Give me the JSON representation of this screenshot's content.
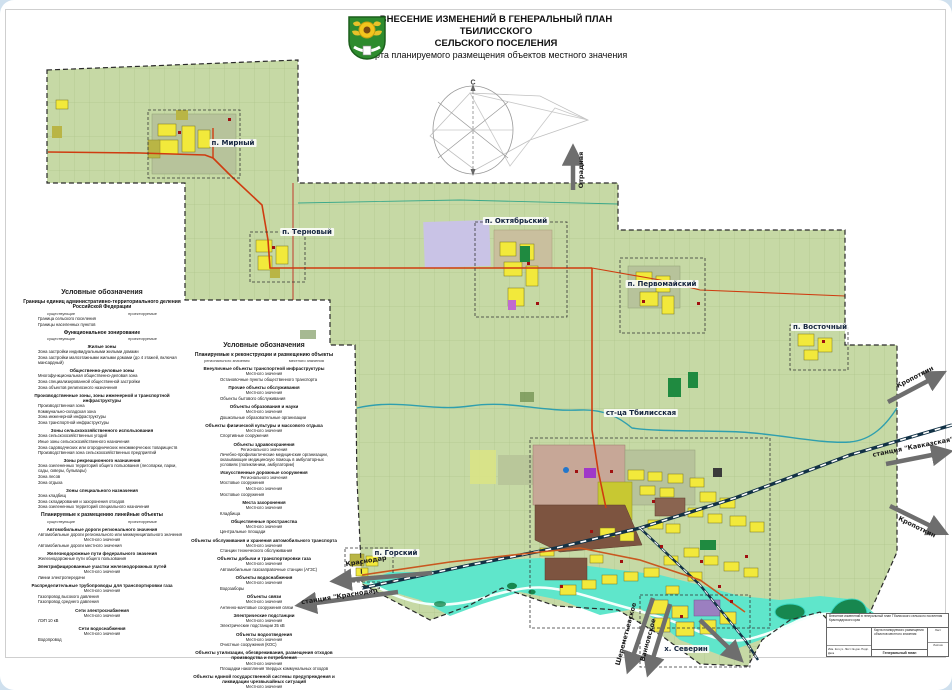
{
  "header": {
    "title_line1": "ВНЕСЕНИЕ ИЗМЕНЕНИЙ В ГЕНЕРАЛЬНЫЙ ПЛАН ТБИЛИССКОГО",
    "title_line2": "СЕЛЬСКОГО ПОСЕЛЕНИЯ",
    "subtitle": "Карта планируемого размещения объектов местного значения"
  },
  "compass": {
    "north": "С",
    "south": "Ю"
  },
  "map": {
    "labels": [
      {
        "text": "п. Мирный",
        "x": 233,
        "y": 143
      },
      {
        "text": "п. Терновый",
        "x": 307,
        "y": 232
      },
      {
        "text": "п. Октябрьский",
        "x": 516,
        "y": 221
      },
      {
        "text": "п. Первомайский",
        "x": 662,
        "y": 284
      },
      {
        "text": "п. Восточный",
        "x": 820,
        "y": 327
      },
      {
        "text": "ст-ца Тбилисская",
        "x": 641,
        "y": 413
      },
      {
        "text": "п. Горский",
        "x": 396,
        "y": 553
      },
      {
        "text": "х. Северин",
        "x": 686,
        "y": 649
      }
    ],
    "arrows": [
      {
        "x1": 573,
        "y1": 190,
        "x2": 573,
        "y2": 150,
        "label": "Отрадная",
        "lx": 581,
        "ly": 170,
        "rot": -90
      },
      {
        "x1": 888,
        "y1": 402,
        "x2": 941,
        "y2": 374,
        "label": "Кропоткин",
        "lx": 915,
        "ly": 377,
        "rot": -27
      },
      {
        "x1": 886,
        "y1": 464,
        "x2": 947,
        "y2": 452,
        "label": "станция \"Кавказская\"",
        "lx": 913,
        "ly": 447,
        "rot": -11
      },
      {
        "x1": 890,
        "y1": 506,
        "x2": 943,
        "y2": 532,
        "label": "Кропоткин",
        "lx": 917,
        "ly": 527,
        "rot": 26
      },
      {
        "x1": 432,
        "y1": 573,
        "x2": 336,
        "y2": 581,
        "label": "Краснодар",
        "lx": 366,
        "ly": 561,
        "rot": -9
      },
      {
        "x1": 398,
        "y1": 592,
        "x2": 301,
        "y2": 605,
        "label": "станция \"Краснодар\"",
        "lx": 341,
        "ly": 596,
        "rot": -9
      },
      {
        "x1": 653,
        "y1": 598,
        "x2": 629,
        "y2": 668,
        "label": "Шереметьевское",
        "lx": 626,
        "ly": 634,
        "rot": -75
      },
      {
        "x1": 670,
        "y1": 604,
        "x2": 649,
        "y2": 671,
        "label": "Ванновское",
        "lx": 648,
        "ly": 640,
        "rot": -75
      },
      {
        "x1": 700,
        "y1": 620,
        "x2": 739,
        "y2": 658,
        "label": "",
        "lx": 0,
        "ly": 0,
        "rot": 0
      }
    ]
  },
  "legend_left": {
    "rows": [
      {
        "t": "h1",
        "label": "Условные обозначения"
      },
      {
        "t": "h2",
        "label": "Границы единиц административно-территориального деления Российской Федерации"
      },
      {
        "t": "cols",
        "a": "существующие",
        "b": "проектируемые"
      },
      {
        "t": "item",
        "sw": "#1c1c1c",
        "swk": "line",
        "label": "Граница сельского поселения"
      },
      {
        "t": "item",
        "sw": "#d43fc0",
        "swk": "dash",
        "label": "Границы населенных пунктов"
      },
      {
        "t": "h2",
        "label": "Функциональное зонирование"
      },
      {
        "t": "cols",
        "a": "существующие",
        "b": "проектируемые"
      },
      {
        "t": "h3",
        "label": "Жилые зоны"
      },
      {
        "t": "item",
        "sw": "#f8ef4a",
        "swk": "rect",
        "label": "Зона застройки индивидуальными жилыми домами"
      },
      {
        "t": "item",
        "sw": "#dfa23b",
        "swk": "rect",
        "label": "Зона застройки малоэтажными жилыми домами (до 4 этажей, включая мансардный)"
      },
      {
        "t": "h3",
        "label": "Общественно-деловые зоны"
      },
      {
        "t": "item",
        "sw": "#d43fc0",
        "swk": "rect",
        "label": "Многофункциональная общественно-деловая зона"
      },
      {
        "t": "item",
        "sw": "#9a63b8",
        "swk": "rect",
        "label": "Зона специализированной общественной застройки"
      },
      {
        "t": "item",
        "sw": "#6f4d9b",
        "swk": "rect",
        "label": "Зона объектов религиозного назначения"
      },
      {
        "t": "h3",
        "label": "Производственные зоны, зоны инженерной и транспортной инфраструктуры"
      },
      {
        "t": "item",
        "sw": "#7c4a38",
        "swk": "rect",
        "label": "Производственная зона"
      },
      {
        "t": "item",
        "sw": "#8f7a66",
        "swk": "rect",
        "label": "Коммунально-складская зона"
      },
      {
        "t": "item",
        "sw": "#33525f",
        "swk": "rect",
        "label": "Зона инженерной инфраструктуры"
      },
      {
        "t": "item",
        "sw": "#24405a",
        "swk": "rect",
        "label": "Зона транспортной инфраструктуры"
      },
      {
        "t": "h3",
        "label": "Зоны сельскохозяйственного использования"
      },
      {
        "t": "item",
        "sw": "#cfc99c",
        "swk": "rect",
        "label": "Зона сельскохозяйственных угодий"
      },
      {
        "t": "item",
        "sw": "#f0eec0",
        "swk": "rect",
        "label": "Иные зоны сельскохозяйственного назначения"
      },
      {
        "t": "item",
        "sw": "#d9e386",
        "swk": "rect",
        "label": "Зона садоводческих или огороднических некоммерческих товариществ"
      },
      {
        "t": "item",
        "sw": "#b5ba3f",
        "swk": "rect",
        "label": "Производственная зона сельскохозяйственных предприятий"
      },
      {
        "t": "h3",
        "label": "Зоны рекреационного назначения"
      },
      {
        "t": "item",
        "sw": "#4fd8a9",
        "swk": "rect",
        "label": "Зона озелененных территорий общего пользования (лесопарки, парки, сады, скверы, бульвары)"
      },
      {
        "t": "item",
        "sw": "#42bd72",
        "swk": "rect",
        "label": "Зона лесов"
      },
      {
        "t": "item",
        "sw": "#e4705e",
        "swk": "rect",
        "label": "Зона отдыха"
      },
      {
        "t": "h3",
        "label": "Зоны специального назначения"
      },
      {
        "t": "item",
        "sw": "#3c3c3c",
        "swk": "rect",
        "label": "Зона кладбищ"
      },
      {
        "t": "item",
        "sw": "#cdbfeb",
        "swk": "rect",
        "label": "Зона складирования и захоронения отходов"
      },
      {
        "t": "item",
        "sw": "#dcd6f2",
        "swk": "rect",
        "label": "Зона озелененных территорий специального назначения"
      },
      {
        "t": "h2",
        "label": "Планируемые к размещению линейные объекты"
      },
      {
        "t": "cols",
        "a": "существующие",
        "b": "проектируемые"
      },
      {
        "t": "h3",
        "label": "Автомобильные дороги регионального значения"
      },
      {
        "t": "item",
        "sw": "#c9571f",
        "swk": "line",
        "label": "Автомобильные дороги регионального или межмуниципального значения"
      },
      {
        "t": "tier",
        "label": "Местного значения"
      },
      {
        "t": "item",
        "sw": "#d98a4a",
        "swk": "line",
        "label": "Автомобильные дороги местного значения"
      },
      {
        "t": "h3",
        "label": "Железнодорожные пути федерального значения"
      },
      {
        "t": "item",
        "sw": "#1c1c1c",
        "swk": "line",
        "label": "Железнодорожные пути общего пользования"
      },
      {
        "t": "h3",
        "label": "Электрифицированные участки железнодорожных путей"
      },
      {
        "t": "tier",
        "label": "Местного значения"
      },
      {
        "t": "item",
        "sw": "#777777",
        "swk": "dash",
        "label": "Линии электропередачи"
      },
      {
        "t": "h3",
        "label": "Распределительные трубопроводы для транспортировки газа"
      },
      {
        "t": "tier",
        "label": "Местного значения"
      },
      {
        "t": "item",
        "sw": "#b8743c",
        "swk": "dash",
        "label": "Газопровод высокого давления"
      },
      {
        "t": "item",
        "sw": "#4a79b0",
        "swk": "dash",
        "label": "Газопровод среднего давления"
      },
      {
        "t": "h3",
        "label": "Сети электроснабжения"
      },
      {
        "t": "tier",
        "label": "Местного значения"
      },
      {
        "t": "item",
        "sw": "#8a5fa0",
        "swk": "dash",
        "label": "ЛЭП 10 кВ"
      },
      {
        "t": "h3",
        "label": "Сети водоснабжения"
      },
      {
        "t": "tier",
        "label": "Местного значения"
      },
      {
        "t": "item",
        "sw": "#3d86c6",
        "swk": "line",
        "label": "Водопровод"
      }
    ]
  },
  "legend_center": {
    "rows": [
      {
        "t": "h1",
        "label": "Условные обозначения"
      },
      {
        "t": "h2",
        "label": "Планируемые к реконструкции и размещению объекты"
      },
      {
        "t": "cols",
        "a": "регионального значения",
        "b": "местного значения"
      },
      {
        "t": "h3",
        "label": "Внеуличные объекты транспортной инфраструктуры"
      },
      {
        "t": "tier",
        "label": "Местного значения"
      },
      {
        "t": "item",
        "sw": "#b01010",
        "swk": "sq",
        "label": "Остановочные пункты общественного транспорта"
      },
      {
        "t": "h3",
        "label": "Прочие объекты обслуживания"
      },
      {
        "t": "tier",
        "label": "Местного значения"
      },
      {
        "t": "item",
        "sw": "#b01010",
        "swk": "sq",
        "label": "Объекты бытового обслуживания"
      },
      {
        "t": "h3",
        "label": "Объекты образования и науки"
      },
      {
        "t": "tier",
        "label": "Местного значения"
      },
      {
        "t": "item",
        "sw": "#b01010",
        "swk": "sq",
        "label": "Дошкольные образовательные организации"
      },
      {
        "t": "h3",
        "label": "Объекты физической культуры и массового отдыха"
      },
      {
        "t": "tier",
        "label": "Местного значения"
      },
      {
        "t": "item",
        "sw": "#b01010",
        "swk": "sq",
        "label": "Спортивные сооружения"
      },
      {
        "t": "h3",
        "label": "Объекты здравоохранения"
      },
      {
        "t": "tier",
        "label": "Регионального значения"
      },
      {
        "t": "item",
        "sw": "#6aa83c",
        "swk": "sq",
        "label": "Лечебно-профилактические медицинские организации, оказывающие медицинскую помощь в амбулаторных условиях (поликлиники, амбулатории)"
      },
      {
        "t": "h3",
        "label": "Искусственные дорожные сооружения"
      },
      {
        "t": "tier",
        "label": "Регионального значения"
      },
      {
        "t": "item",
        "sw": "#b01010",
        "swk": "sq",
        "label": "Мостовые сооружения"
      },
      {
        "t": "tier",
        "label": "Местного значения"
      },
      {
        "t": "item",
        "sw": "#b01010",
        "swk": "sq",
        "label": "Мостовые сооружения"
      },
      {
        "t": "h3",
        "label": "Места захоронения"
      },
      {
        "t": "tier",
        "label": "Местного значения"
      },
      {
        "t": "item",
        "sw": "#b01010",
        "swk": "sq",
        "label": "Кладбища"
      },
      {
        "t": "h3",
        "label": "Общественные пространства"
      },
      {
        "t": "tier",
        "label": "Местного значения"
      },
      {
        "t": "item",
        "sw": "#b01010",
        "swk": "sq",
        "label": "Центральные площади"
      },
      {
        "t": "h3",
        "label": "Объекты обслуживания и хранения автомобильного транспорта"
      },
      {
        "t": "tier",
        "label": "Местного значения"
      },
      {
        "t": "item",
        "sw": "#b01010",
        "swk": "sq",
        "label": "Станции технического обслуживания"
      },
      {
        "t": "h3",
        "label": "Объекты добычи и транспортировки газа"
      },
      {
        "t": "tier",
        "label": "Местного значения"
      },
      {
        "t": "item",
        "sw": "#b01010",
        "swk": "sq",
        "label": "Автомобильные газозаправочные станции (АГЗС)"
      },
      {
        "t": "h3",
        "label": "Объекты водоснабжения"
      },
      {
        "t": "tier",
        "label": "Местного значения"
      },
      {
        "t": "item",
        "sw": "#b01010",
        "swk": "sq",
        "label": "Водозаборы"
      },
      {
        "t": "h3",
        "label": "Объекты связи"
      },
      {
        "t": "tier",
        "label": "Местного значения"
      },
      {
        "t": "item",
        "sw": "#b01010",
        "swk": "sq",
        "label": "Антенно-мачтовые сооружения связи"
      },
      {
        "t": "h3",
        "label": "Электрические подстанции"
      },
      {
        "t": "tier",
        "label": "Местного значения"
      },
      {
        "t": "item",
        "sw": "#b01010",
        "swk": "sq",
        "label": "Электрические подстанции 35 кВ"
      },
      {
        "t": "h3",
        "label": "Объекты водоотведения"
      },
      {
        "t": "tier",
        "label": "Местного значения"
      },
      {
        "t": "item",
        "sw": "#b01010",
        "swk": "sq",
        "label": "Очистные сооружения (КОС)"
      },
      {
        "t": "h3",
        "label": "Объекты утилизации, обезвреживания, размещения отходов производства и потребления"
      },
      {
        "t": "tier",
        "label": "Местного значения"
      },
      {
        "t": "item",
        "sw": "#b01010",
        "swk": "sq",
        "label": "Площадки накопления твердых коммунальных отходов"
      },
      {
        "t": "h3",
        "label": "Объекты единой государственной системы предупреждения и ликвидации чрезвычайных ситуаций"
      },
      {
        "t": "tier",
        "label": "Местного значения"
      },
      {
        "t": "item",
        "sw": "#b01010",
        "swk": "sq",
        "label": "Пожарные депо (пожарные части)"
      },
      {
        "t": "noteh",
        "label": "Примечание:"
      },
      {
        "t": "item",
        "sw": "#7a1010",
        "swk": "sq",
        "label": "Объекты, планируемые к реконструкции"
      },
      {
        "t": "item",
        "sw": "#e8d93c",
        "swk": "sq",
        "label": "Объекты, планируемые к размещению"
      }
    ]
  },
  "title_block": {
    "project": "Внесение изменений в генеральный план Тбилисского сельского поселения Краснодарского края",
    "map_name": "Карта планируемого размещения объектов местного значения",
    "doc": "Генеральный план",
    "cells": "Изм.  Кол.уч.  Лист  № док.  Подп.  Дата",
    "sheet": "Лист",
    "sheets": "Листов"
  }
}
